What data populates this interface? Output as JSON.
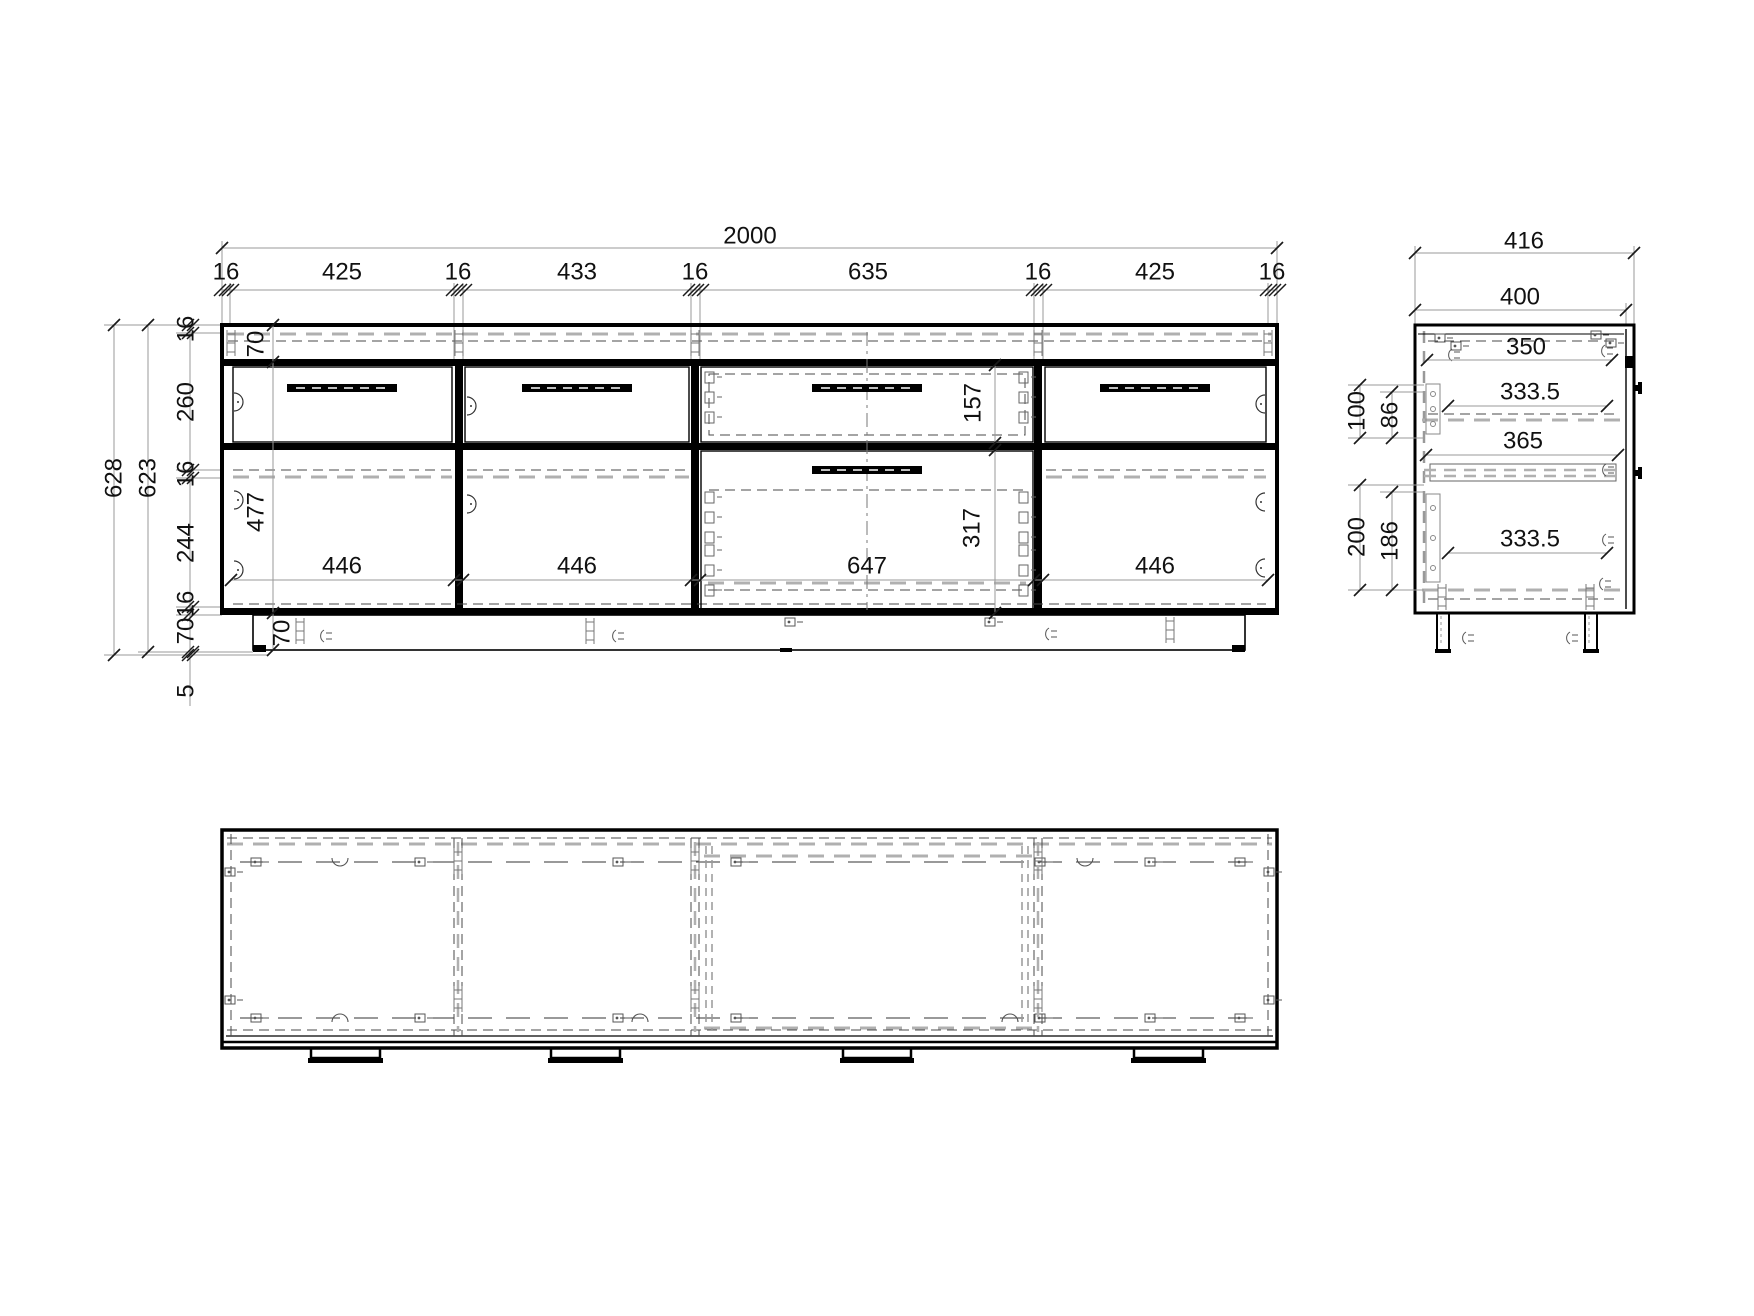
{
  "view": {
    "type": "technical-drawing",
    "subject": "sideboard cabinet - front, side and bottom orthographic views",
    "background": "#ffffff",
    "line_color": "#000000",
    "dimension_color": "#111111"
  },
  "front": {
    "overall_width": "2000",
    "width_chain": [
      "16",
      "425",
      "16",
      "433",
      "16",
      "635",
      "16",
      "425",
      "16"
    ],
    "overall_height": "628",
    "body_height": "623",
    "height_chain": [
      "16",
      "260",
      "16",
      "244",
      "16",
      "70",
      "5"
    ],
    "top_rail_height": "70",
    "interior_height": "477",
    "plinth_height": "70",
    "opening_widths": [
      "446",
      "446",
      "647",
      "446"
    ],
    "top_drawer_height": "157",
    "bottom_drawer_height": "317"
  },
  "side": {
    "overall_depth": "416",
    "body_depth": "400",
    "depth_dims": [
      "350",
      "333.5",
      "365",
      "333.5"
    ],
    "height_dims": [
      "100",
      "86",
      "200",
      "186"
    ]
  }
}
